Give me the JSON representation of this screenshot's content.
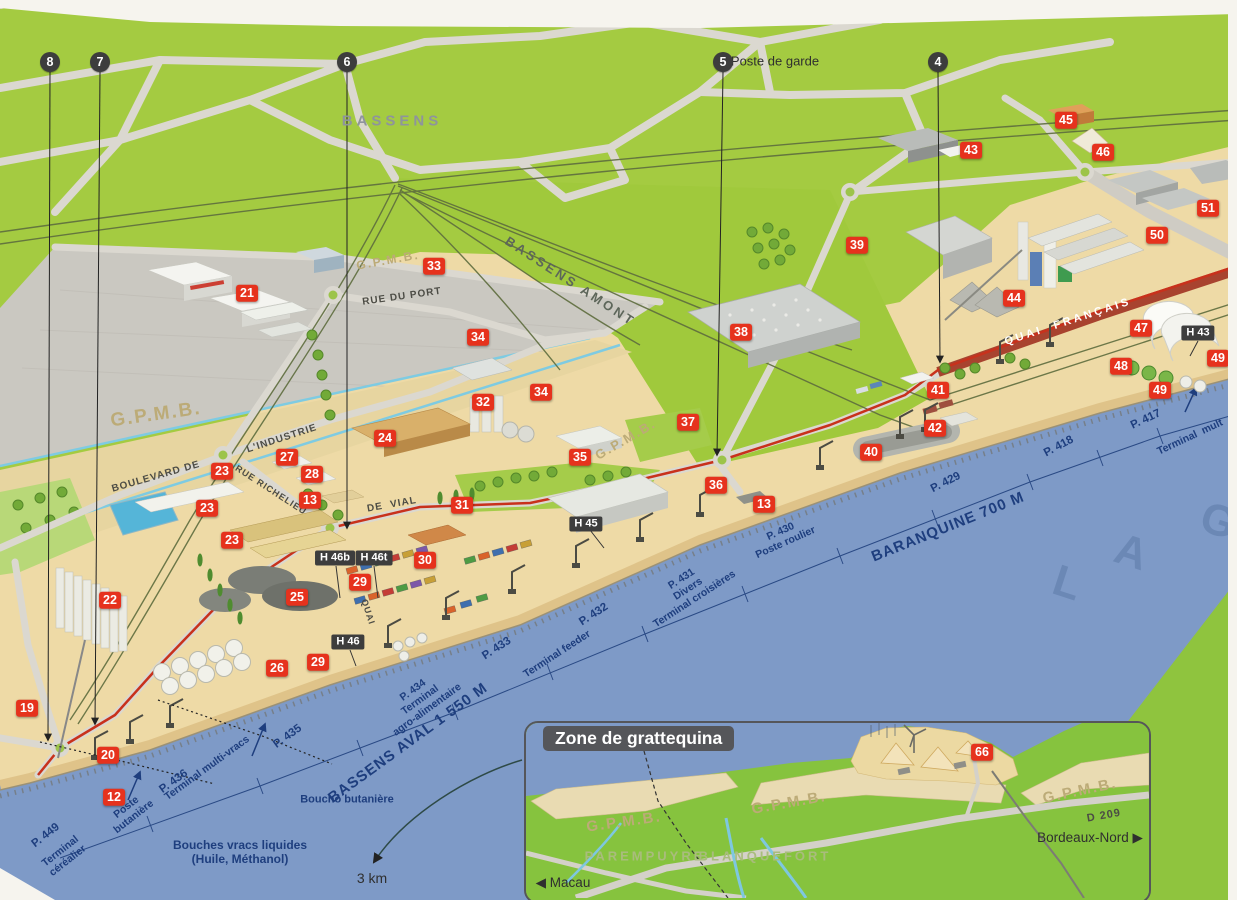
{
  "inset": {
    "title": "Zone de grattequina"
  },
  "colors": {
    "land_green": "#a4cb41",
    "water_blue": "#7e9ac7",
    "port_sand": "#eedaa6",
    "marker_red": "#e6321d",
    "marker_dark": "#3d3d3d",
    "river_text": "#1e3e7e",
    "route_red": "#c8311c",
    "quai_road": "#a8432f"
  },
  "labels": [
    {
      "name": "label-bassens",
      "text": "BASSENS",
      "x": 392,
      "y": 121,
      "rot": 0,
      "cls": "city"
    },
    {
      "name": "label-bassens-amont",
      "text": "BASSENS AMONT",
      "x": 570,
      "y": 282,
      "rot": 33,
      "cls": "rail"
    },
    {
      "name": "label-poste-de-garde",
      "text": "Poste de garde",
      "x": 775,
      "y": 62,
      "rot": 0,
      "cls": "note"
    },
    {
      "name": "label-rue-du-port",
      "text": "RUE DU PORT",
      "x": 402,
      "y": 297,
      "rot": -8,
      "cls": "road"
    },
    {
      "name": "label-boulevard-de",
      "text": "BOULEVARD DE",
      "x": 156,
      "y": 477,
      "rot": -16,
      "cls": "road"
    },
    {
      "name": "label-industrie",
      "text": "L'INDUSTRIE",
      "x": 282,
      "y": 439,
      "rot": -18,
      "cls": "road"
    },
    {
      "name": "label-rue-richelieu",
      "text": "RUE RICHELIEU",
      "x": 271,
      "y": 490,
      "rot": 33,
      "cls": "road",
      "fs": 9
    },
    {
      "name": "label-de-vial",
      "text": "DE  VIAL",
      "x": 392,
      "y": 505,
      "rot": -10,
      "cls": "road"
    },
    {
      "name": "label-quai-sw",
      "text": "QUAI",
      "x": 368,
      "y": 612,
      "rot": 72,
      "cls": "road",
      "fs": 9
    },
    {
      "name": "label-quai-francais",
      "text": "QUAI  FRANÇAIS",
      "x": 1068,
      "y": 322,
      "rot": -18,
      "cls": "quai"
    },
    {
      "name": "label-gpmb-1",
      "text": "G.P.M.B.",
      "x": 388,
      "y": 261,
      "rot": -10,
      "cls": "gpmb",
      "fs": 12
    },
    {
      "name": "label-gpmb-2",
      "text": "G.P.M.B.",
      "x": 156,
      "y": 415,
      "rot": -8,
      "cls": "gpmb",
      "fs": 19
    },
    {
      "name": "label-gpmb-3",
      "text": "G.P.M.B.",
      "x": 626,
      "y": 440,
      "rot": -30,
      "cls": "gpmb",
      "fs": 13
    },
    {
      "name": "label-p449",
      "text": "P. 449",
      "x": 46,
      "y": 836,
      "rot": -38,
      "cls": "river"
    },
    {
      "name": "label-terminal-cerealier",
      "text": "Terminal\ncéréalier",
      "x": 64,
      "y": 856,
      "rot": -38,
      "cls": "river-sm"
    },
    {
      "name": "label-poste-butaniere",
      "text": "Poste\nbutanière",
      "x": 130,
      "y": 812,
      "rot": -38,
      "cls": "river-sm"
    },
    {
      "name": "label-p436",
      "text": "P. 436",
      "x": 174,
      "y": 782,
      "rot": -36,
      "cls": "river"
    },
    {
      "name": "label-terminal-multivracs",
      "text": "Terminal multi-vracs",
      "x": 207,
      "y": 768,
      "rot": -36,
      "cls": "river-sm"
    },
    {
      "name": "label-p435",
      "text": "P. 435",
      "x": 288,
      "y": 737,
      "rot": -36,
      "cls": "river"
    },
    {
      "name": "label-bouches-vracs",
      "text": "Bouches vracs liquides\n(Huile, Méthanol)",
      "x": 240,
      "y": 853,
      "rot": 0,
      "cls": "river",
      "fs": 12
    },
    {
      "name": "label-boucho-butaniere",
      "text": "Boucho butanière",
      "x": 347,
      "y": 800,
      "rot": 0,
      "cls": "river-sm",
      "fs": 11
    },
    {
      "name": "label-bassens-aval",
      "text": "BASSENS AVAL 1 550 M",
      "x": 408,
      "y": 743,
      "rot": -36,
      "cls": "river-big"
    },
    {
      "name": "label-p434",
      "text": "P. 434\nTerminal\nagro-alimentaire",
      "x": 420,
      "y": 700,
      "rot": -36,
      "cls": "river-sm"
    },
    {
      "name": "label-p433",
      "text": "P. 433",
      "x": 497,
      "y": 649,
      "rot": -33,
      "cls": "river"
    },
    {
      "name": "label-terminal-feeder",
      "text": "Terminal feeder",
      "x": 557,
      "y": 654,
      "rot": -33,
      "cls": "river-sm"
    },
    {
      "name": "label-p432",
      "text": "P. 432",
      "x": 594,
      "y": 615,
      "rot": -33,
      "cls": "river"
    },
    {
      "name": "label-p431",
      "text": "P. 431\nDivers\nTerminal croisières",
      "x": 688,
      "y": 589,
      "rot": -33,
      "cls": "river-sm"
    },
    {
      "name": "label-p430",
      "text": "P. 430\nPoste roulier",
      "x": 783,
      "y": 537,
      "rot": -24,
      "cls": "river-sm"
    },
    {
      "name": "label-baranquine",
      "text": "BARANQUINE 700 M",
      "x": 948,
      "y": 527,
      "rot": -22,
      "cls": "river-big"
    },
    {
      "name": "label-p429",
      "text": "P. 429",
      "x": 946,
      "y": 483,
      "rot": -27,
      "cls": "river"
    },
    {
      "name": "label-p418",
      "text": "P. 418",
      "x": 1059,
      "y": 447,
      "rot": -28,
      "cls": "river"
    },
    {
      "name": "label-p417",
      "text": "P. 417",
      "x": 1146,
      "y": 420,
      "rot": -25,
      "cls": "river"
    },
    {
      "name": "label-terminal-mult",
      "text": "Terminal  mult",
      "x": 1190,
      "y": 437,
      "rot": -25,
      "cls": "river-sm"
    },
    {
      "name": "label-garonne-l",
      "text": "L",
      "x": 1068,
      "y": 584,
      "rot": 18,
      "cls": "garonne"
    },
    {
      "name": "label-garonne-a",
      "text": "A",
      "x": 1132,
      "y": 553,
      "rot": 18,
      "cls": "garonne"
    },
    {
      "name": "label-garonne-g",
      "text": "G",
      "x": 1219,
      "y": 522,
      "rot": 18,
      "cls": "garonne"
    },
    {
      "name": "label-3km",
      "text": "3 km",
      "x": 372,
      "y": 878,
      "rot": 0,
      "cls": "note",
      "fs": 14
    },
    {
      "name": "label-inset-gpmb-1",
      "text": "G.P.M.B.",
      "x": 624,
      "y": 822,
      "rot": -8,
      "cls": "gpmb",
      "fs": 15
    },
    {
      "name": "label-inset-gpmb-2",
      "text": "G.P.M.B.",
      "x": 789,
      "y": 803,
      "rot": -10,
      "cls": "gpmb",
      "fs": 15
    },
    {
      "name": "label-inset-gpmb-3",
      "text": "G.P.M.B.",
      "x": 1080,
      "y": 791,
      "rot": -12,
      "cls": "gpmb",
      "fs": 15
    },
    {
      "name": "label-parempuyre",
      "text": "PAREMPUYRE",
      "x": 645,
      "y": 857,
      "rot": 0,
      "cls": "inset-city"
    },
    {
      "name": "label-blanquefort",
      "text": "BLANQUEFORT",
      "x": 765,
      "y": 857,
      "rot": 0,
      "cls": "inset-city"
    },
    {
      "name": "label-macau",
      "text": "◀ Macau",
      "x": 563,
      "y": 883,
      "rot": 0,
      "cls": "note",
      "fs": 13.5
    },
    {
      "name": "label-d209",
      "text": "D 209",
      "x": 1104,
      "y": 816,
      "rot": -10,
      "cls": "road",
      "fs": 11
    },
    {
      "name": "label-bordeaux-nord",
      "text": "Bordeaux-Nord ▶",
      "x": 1090,
      "y": 838,
      "rot": 0,
      "cls": "note",
      "fs": 13.5
    }
  ],
  "red_markers": [
    {
      "n": "21",
      "x": 247,
      "y": 293
    },
    {
      "n": "45",
      "x": 1066,
      "y": 120
    },
    {
      "n": "43",
      "x": 971,
      "y": 150
    },
    {
      "n": "46",
      "x": 1103,
      "y": 152
    },
    {
      "n": "51",
      "x": 1208,
      "y": 208
    },
    {
      "n": "50",
      "x": 1157,
      "y": 235
    },
    {
      "n": "39",
      "x": 857,
      "y": 245
    },
    {
      "n": "44",
      "x": 1014,
      "y": 298
    },
    {
      "n": "33",
      "x": 434,
      "y": 266
    },
    {
      "n": "34",
      "x": 478,
      "y": 337
    },
    {
      "n": "38",
      "x": 741,
      "y": 332
    },
    {
      "n": "34",
      "x": 541,
      "y": 392
    },
    {
      "n": "32",
      "x": 483,
      "y": 402
    },
    {
      "n": "24",
      "x": 385,
      "y": 438
    },
    {
      "n": "35",
      "x": 580,
      "y": 457
    },
    {
      "n": "37",
      "x": 688,
      "y": 422
    },
    {
      "n": "41",
      "x": 938,
      "y": 390
    },
    {
      "n": "42",
      "x": 935,
      "y": 428
    },
    {
      "n": "40",
      "x": 871,
      "y": 452
    },
    {
      "n": "36",
      "x": 716,
      "y": 485
    },
    {
      "n": "13",
      "x": 764,
      "y": 504
    },
    {
      "n": "23",
      "x": 222,
      "y": 471
    },
    {
      "n": "27",
      "x": 287,
      "y": 457
    },
    {
      "n": "28",
      "x": 312,
      "y": 474
    },
    {
      "n": "13",
      "x": 310,
      "y": 500
    },
    {
      "n": "23",
      "x": 207,
      "y": 508
    },
    {
      "n": "31",
      "x": 462,
      "y": 505
    },
    {
      "n": "23",
      "x": 232,
      "y": 540
    },
    {
      "n": "30",
      "x": 425,
      "y": 560
    },
    {
      "n": "29",
      "x": 360,
      "y": 582
    },
    {
      "n": "25",
      "x": 297,
      "y": 597
    },
    {
      "n": "22",
      "x": 110,
      "y": 600
    },
    {
      "n": "26",
      "x": 277,
      "y": 668
    },
    {
      "n": "29",
      "x": 318,
      "y": 662
    },
    {
      "n": "19",
      "x": 27,
      "y": 708
    },
    {
      "n": "20",
      "x": 108,
      "y": 755
    },
    {
      "n": "12",
      "x": 114,
      "y": 797
    },
    {
      "n": "47",
      "x": 1141,
      "y": 328
    },
    {
      "n": "48",
      "x": 1121,
      "y": 366
    },
    {
      "n": "49",
      "x": 1218,
      "y": 358
    },
    {
      "n": "49",
      "x": 1160,
      "y": 390
    },
    {
      "n": "66",
      "x": 982,
      "y": 752
    }
  ],
  "dark_markers": [
    {
      "n": "8",
      "x": 50,
      "y": 62,
      "ex": 48,
      "ey": 740
    },
    {
      "n": "7",
      "x": 100,
      "y": 62,
      "ex": 95,
      "ey": 724
    },
    {
      "n": "6",
      "x": 347,
      "y": 62,
      "ex": 347,
      "ey": 528
    },
    {
      "n": "5",
      "x": 723,
      "y": 62,
      "ex": 717,
      "ey": 455
    },
    {
      "n": "4",
      "x": 938,
      "y": 62,
      "ex": 940,
      "ey": 362
    }
  ],
  "hangar_badges": [
    {
      "label": "H 45",
      "x": 586,
      "y": 524
    },
    {
      "label": "H 46b",
      "x": 335,
      "y": 558
    },
    {
      "label": "H 46t",
      "x": 374,
      "y": 558
    },
    {
      "label": "H 46",
      "x": 348,
      "y": 642
    },
    {
      "label": "H 43",
      "x": 1198,
      "y": 333
    }
  ]
}
